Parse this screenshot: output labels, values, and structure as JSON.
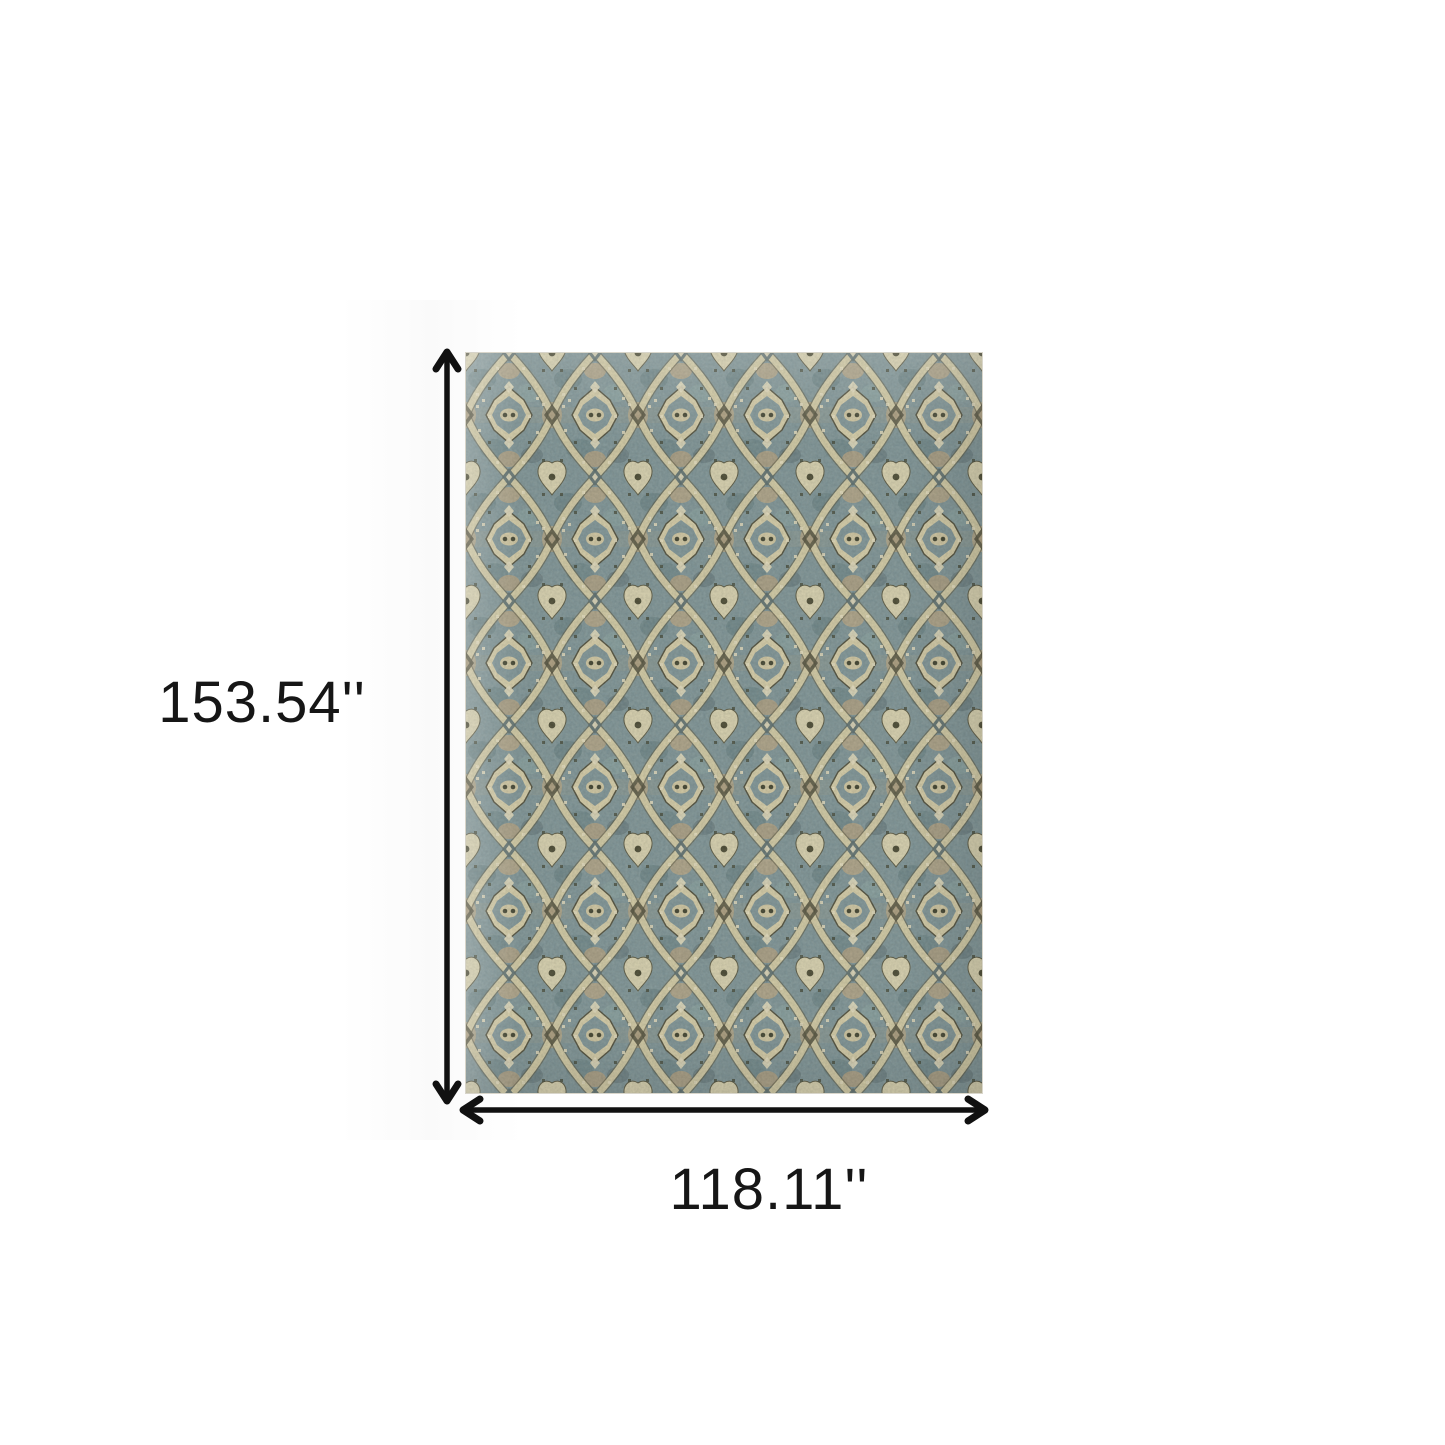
{
  "figure": {
    "type": "product-dimension-diagram",
    "rug": {
      "alt": "Blue and beige distressed traditional medallion area rug",
      "palette": {
        "teal": "#7e959a",
        "teal_dark": "#5e7a80",
        "slate": "#46545a",
        "cream": "#dcd2ac",
        "cream_light": "#eae2c4",
        "tan": "#b7a787",
        "dark_brown": "#4a4836"
      }
    },
    "dimensions": {
      "height_label": "153.54''",
      "width_label": "118.11''"
    },
    "icons": {
      "height_arrow": "double-headed-arrow-vertical",
      "width_arrow": "double-headed-arrow-horizontal"
    },
    "style": {
      "arrow_color": "#111111",
      "text_color": "#161616",
      "background": "#ffffff"
    }
  }
}
